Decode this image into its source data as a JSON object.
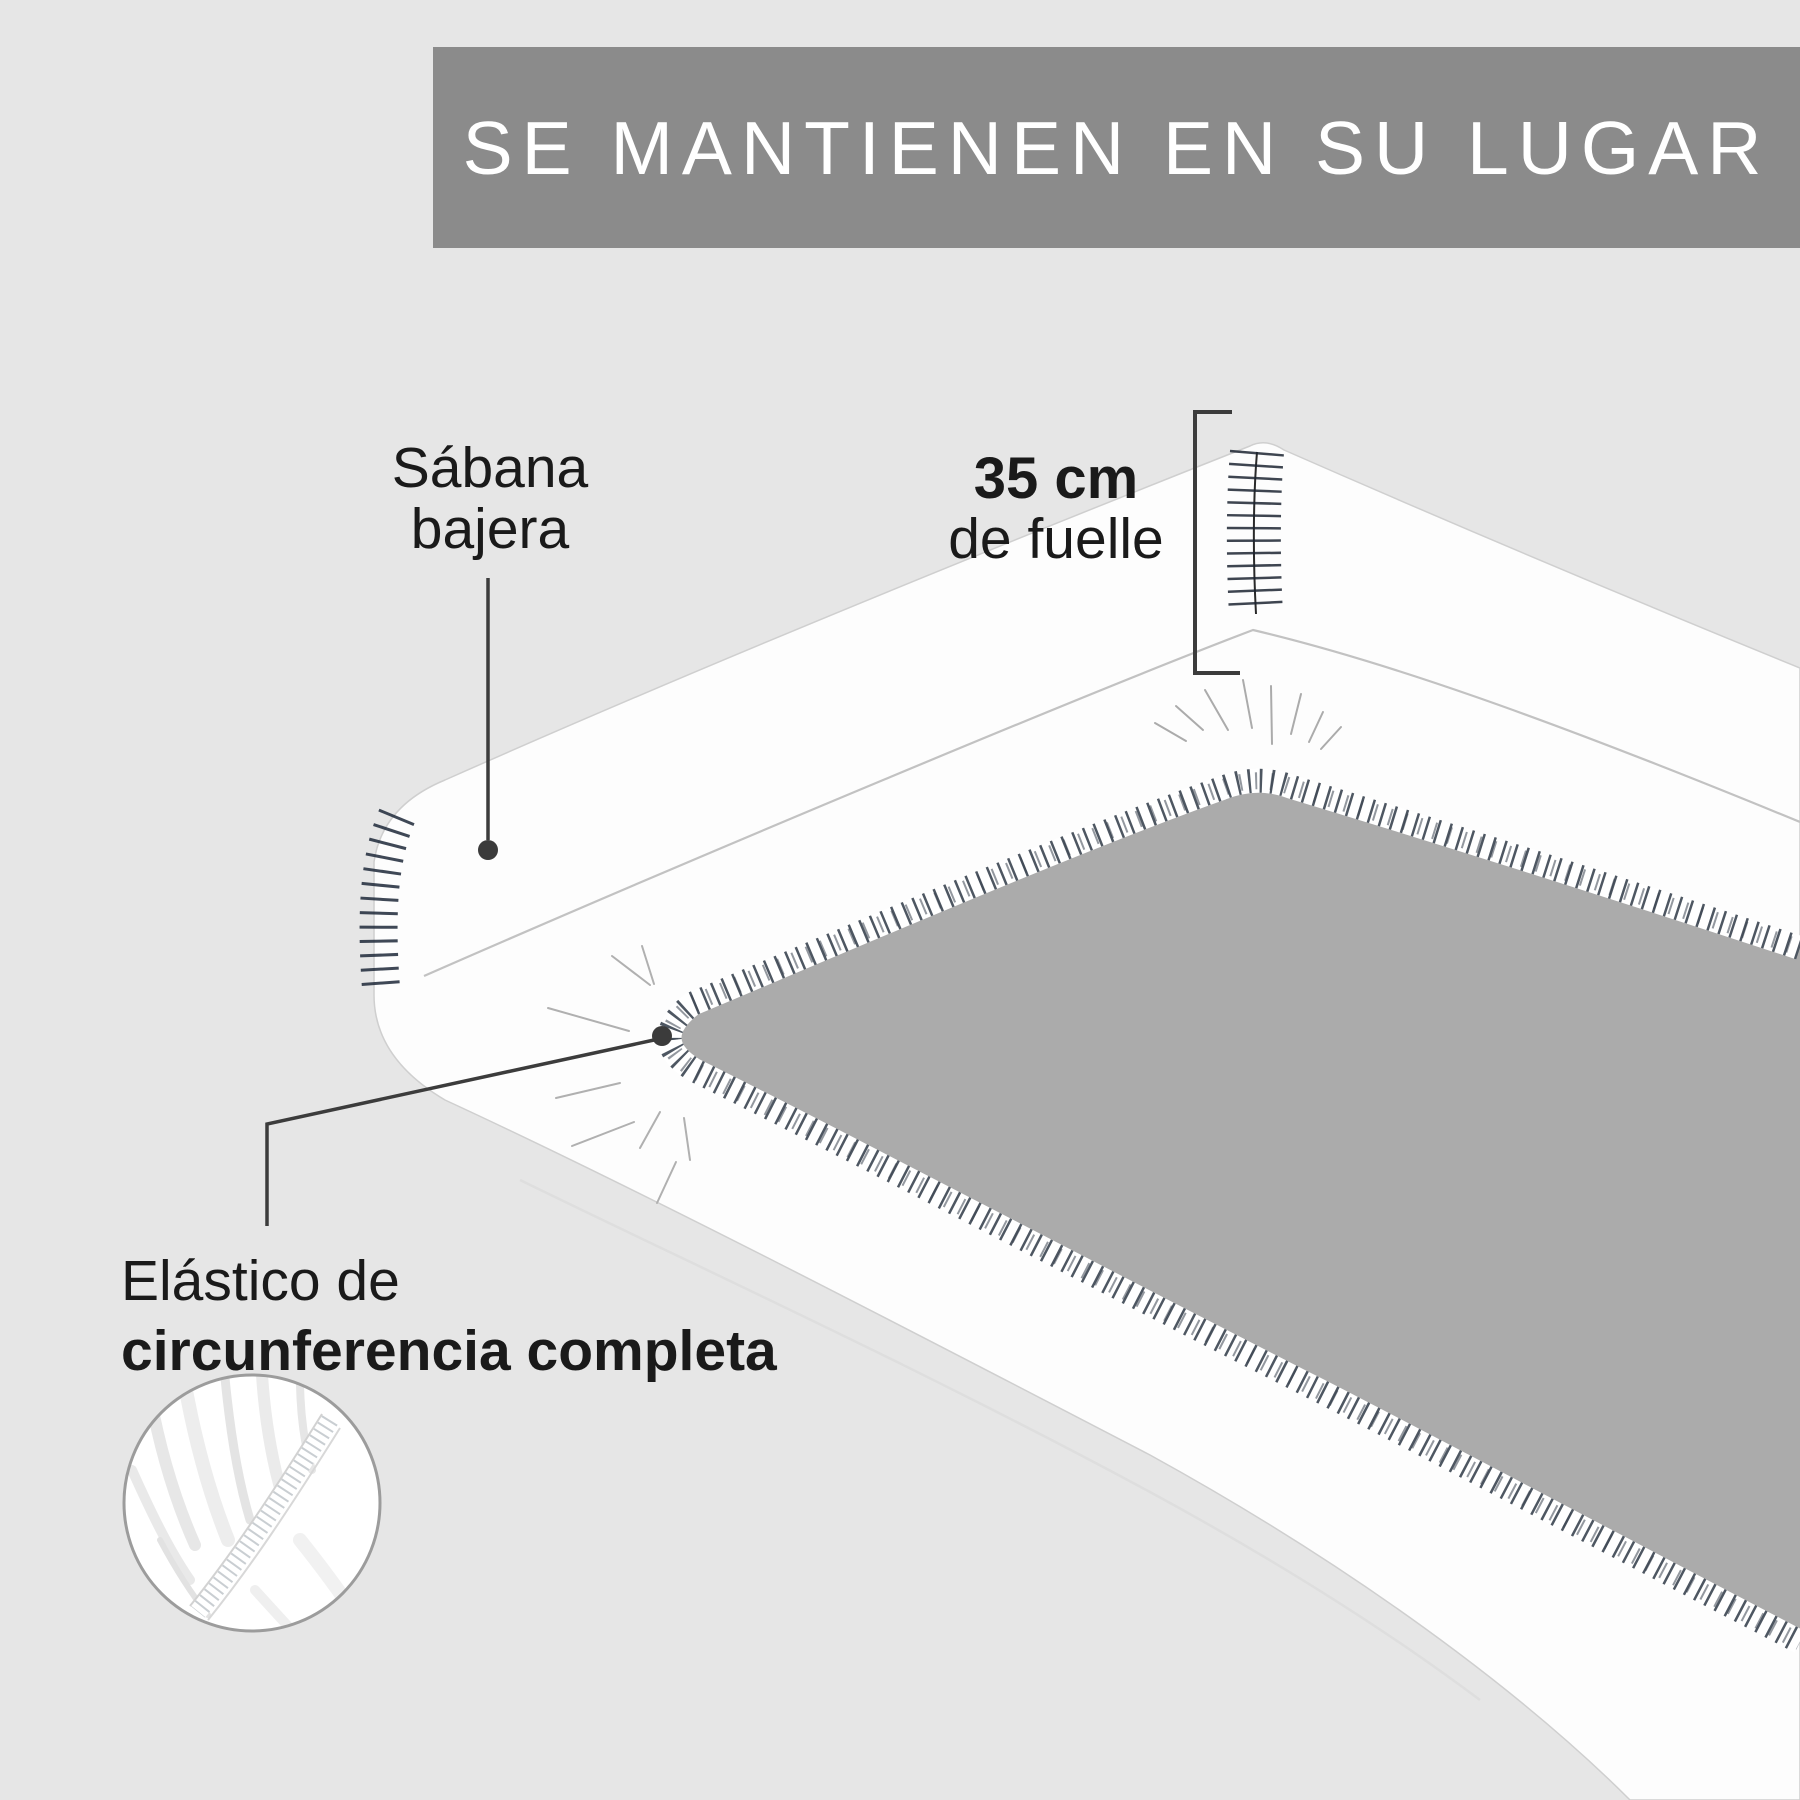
{
  "banner": {
    "title": "SE MANTIENEN EN SU LUGAR",
    "bg_color": "#8b8b8b",
    "text_color": "#ffffff"
  },
  "callouts": {
    "sheet": {
      "line1": "Sábana",
      "line2": "bajera"
    },
    "gusset": {
      "value": "35 cm",
      "caption": "de fuelle"
    },
    "elastic": {
      "line1": "Elástico de",
      "line2": "circunferencia completa"
    }
  },
  "colors": {
    "background": "#e6e6e6",
    "banner": "#8b8b8b",
    "label_text": "#1a1a1a",
    "annotation": "#3c3c3c",
    "sheet_white": "#fdfdfd",
    "mattress_opening_gray": "#ababab",
    "hem_stitch": "#2f3947"
  }
}
